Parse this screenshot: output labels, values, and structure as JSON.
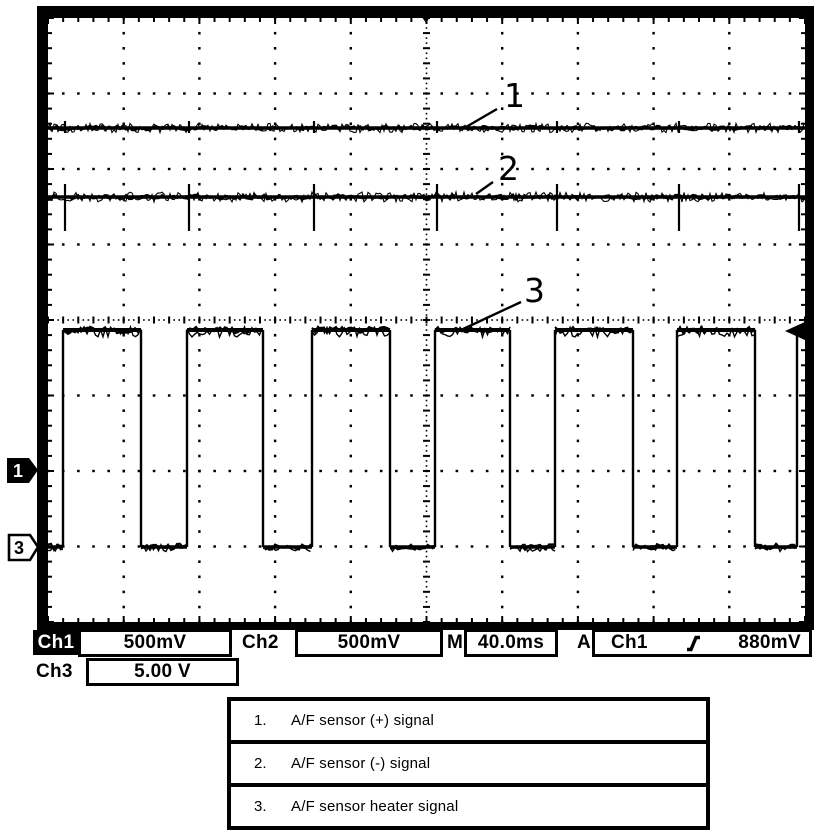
{
  "readout": {
    "ch1_label": "Ch1",
    "ch1_scale": "500mV",
    "ch2_label": "Ch2",
    "ch2_scale": "500mV",
    "time_label": "M",
    "time_base": "40.0ms",
    "trig_mode": "A",
    "trig_source": "Ch1",
    "trig_level": "880mV",
    "ch3_label": "Ch3",
    "ch3_scale": "5.00 V"
  },
  "icons": {
    "trigger_slope": "rising-edge"
  },
  "legend": {
    "rows": [
      {
        "num": "1.",
        "text": "A/F sensor (+) signal"
      },
      {
        "num": "2.",
        "text": "A/F sensor (-) signal"
      },
      {
        "num": "3.",
        "text": "A/F sensor heater signal"
      }
    ]
  },
  "chart_data": {
    "type": "line",
    "title": "Oscilloscope capture of A/F sensor signals",
    "x_axis": {
      "scale_per_div": "40.0 ms",
      "divisions": 10
    },
    "y_axis": {
      "divisions": 8,
      "ch1_scale_per_div": "500 mV",
      "ch2_scale_per_div": "500 mV",
      "ch3_scale_per_div": "5.00 V"
    },
    "trigger": {
      "mode": "A",
      "source": "Ch1",
      "slope": "rising",
      "level": "880mV"
    },
    "grid": {
      "style": "dotted",
      "minor_per_div": 5
    },
    "screen": {
      "outer": [
        37,
        6,
        814,
        630
      ],
      "interior": [
        48,
        18,
        805,
        622
      ]
    },
    "series": [
      {
        "name": "1",
        "label": "A/F sensor (+) signal",
        "kind": "flat",
        "y_px": 128,
        "noise_px": 2.2,
        "spikes": {
          "x_px": [
            65,
            189,
            314,
            437,
            557,
            679,
            799
          ],
          "up_px": 7,
          "down_px": 5
        }
      },
      {
        "name": "2",
        "label": "A/F sensor (-) signal",
        "kind": "flat",
        "y_px": 197,
        "noise_px": 2.4,
        "spikes": {
          "x_px": [
            65,
            189,
            314,
            437,
            557,
            679,
            799
          ],
          "up_px": 13,
          "down_px": 34
        }
      },
      {
        "name": "3",
        "label": "A/F sensor heater signal",
        "kind": "square",
        "high_y_px": 330,
        "low_y_px": 547,
        "start_level": "low",
        "edges_x_px": [
          63,
          141,
          187,
          263,
          312,
          390,
          435,
          510,
          555,
          633,
          677,
          755,
          797
        ],
        "noise_px": 3.2,
        "period_est_ms": 64,
        "duty_high_est": 0.63
      }
    ],
    "annotations": [
      {
        "text": "1",
        "tx": 504,
        "ty": 107,
        "leader": [
          497,
          109,
          466,
          127
        ]
      },
      {
        "text": "2",
        "tx": 498,
        "ty": 180,
        "leader": [
          493,
          182,
          476,
          194
        ]
      },
      {
        "text": "3",
        "tx": 524,
        "ty": 302,
        "leader": [
          521,
          302,
          461,
          330
        ]
      }
    ],
    "markers": {
      "trigger_top_x_px": 426,
      "ch1_ground_marker": {
        "label": "1",
        "y_px": 470,
        "style": "filled"
      },
      "ch3_ground_marker": {
        "label": "3",
        "y_px": 547,
        "style": "outline"
      },
      "right_arrow_y_px": 331
    }
  }
}
